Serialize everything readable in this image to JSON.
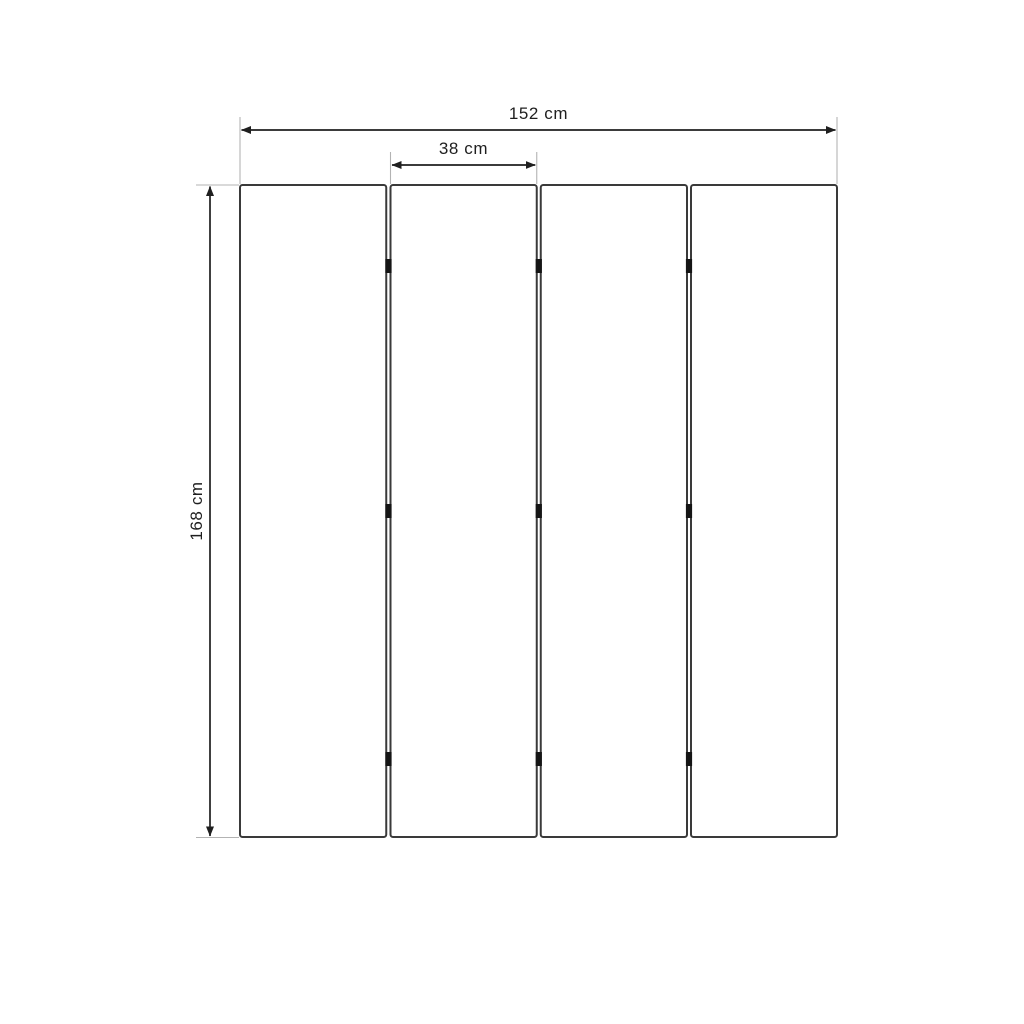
{
  "diagram": {
    "title": "Four-panel folding screen dimension drawing (front view)",
    "panels": {
      "count": 4,
      "hinge_joints": 3,
      "hinges_per_joint": 3
    },
    "dimensions": {
      "total_width": {
        "label": "152 cm",
        "value": 152,
        "unit": "cm"
      },
      "panel_width": {
        "label": "38 cm",
        "value": 38,
        "unit": "cm"
      },
      "height": {
        "label": "168 cm",
        "value": 168,
        "unit": "cm"
      }
    },
    "colors": {
      "background": "#ffffff",
      "panel_border": "#3a3a3a",
      "panel_fill": "#ffffff",
      "dimension_line": "#1f1f1f",
      "extension_line": "#b3b3b3",
      "hinge": "#151515",
      "label_text": "#1f1f1f"
    }
  }
}
